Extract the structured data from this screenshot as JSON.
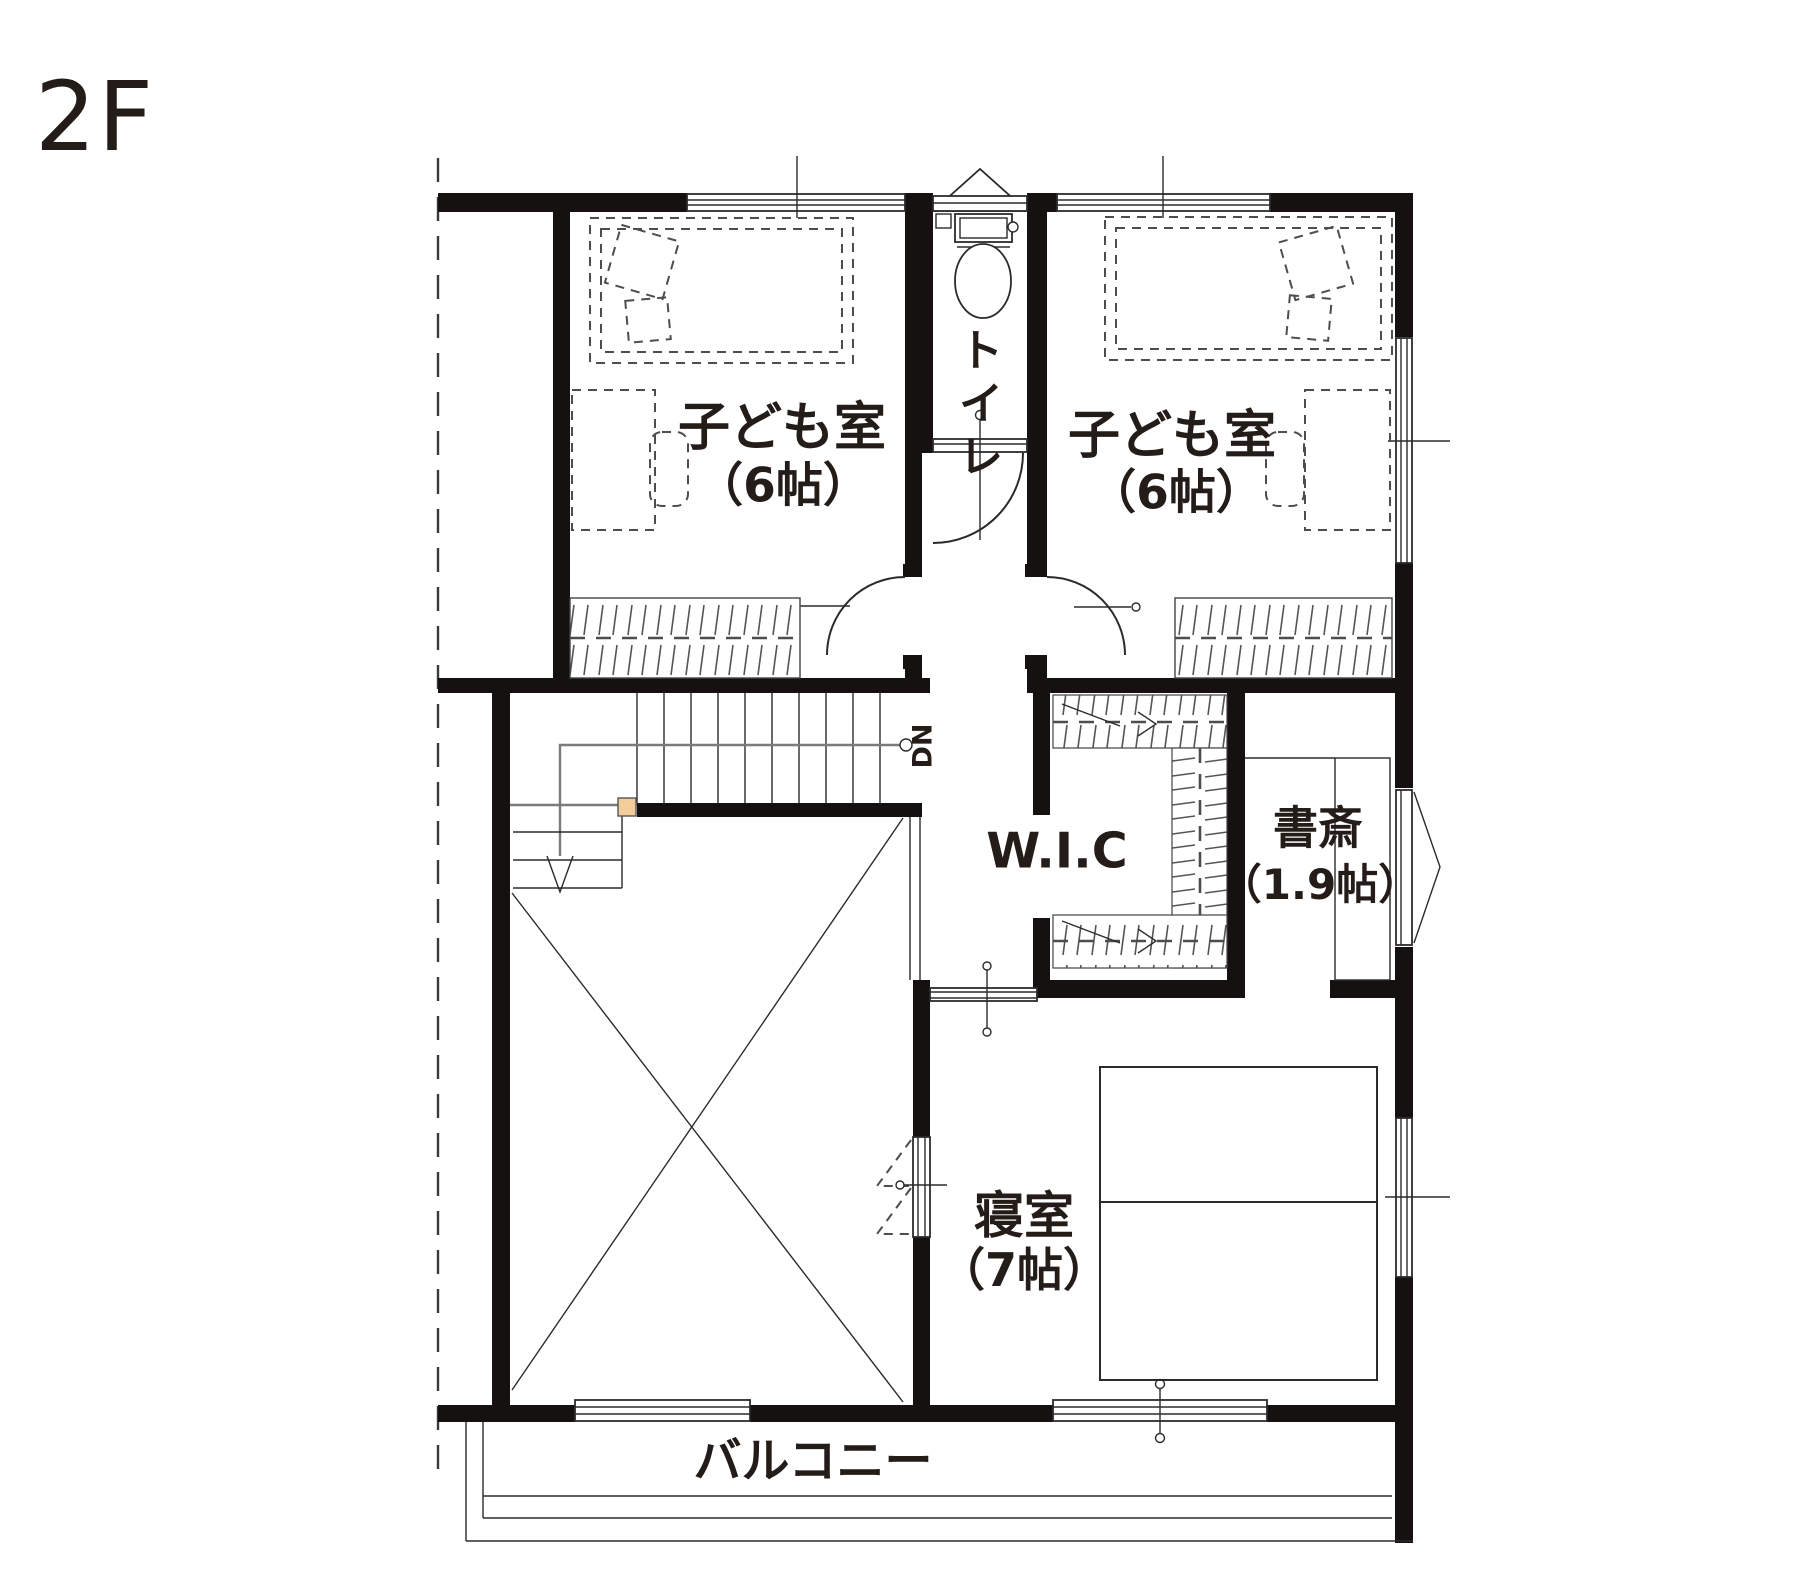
{
  "page": {
    "title": "2F 間取り図"
  },
  "floor": {
    "label": "2F"
  },
  "rooms": {
    "child_room_left": {
      "label": "子ども室",
      "area": "（6帖）"
    },
    "child_room_right": {
      "label": "子ども室",
      "area": "（6帖）"
    },
    "toilet": {
      "label": "トイレ"
    },
    "wic": {
      "label": "W.I.C"
    },
    "study": {
      "label": "書斎",
      "area": "（1.9帖）"
    },
    "bedroom": {
      "label": "寝室",
      "area": "（7帖）"
    },
    "balcony": {
      "label": "バルコニー"
    }
  },
  "stairs": {
    "down_label": "DN"
  },
  "colors": {
    "background": "#ffffff",
    "wall": "#141110",
    "line": "#2b2b2b",
    "text": "#241c18",
    "stair_landing": "#f2cc9b"
  }
}
